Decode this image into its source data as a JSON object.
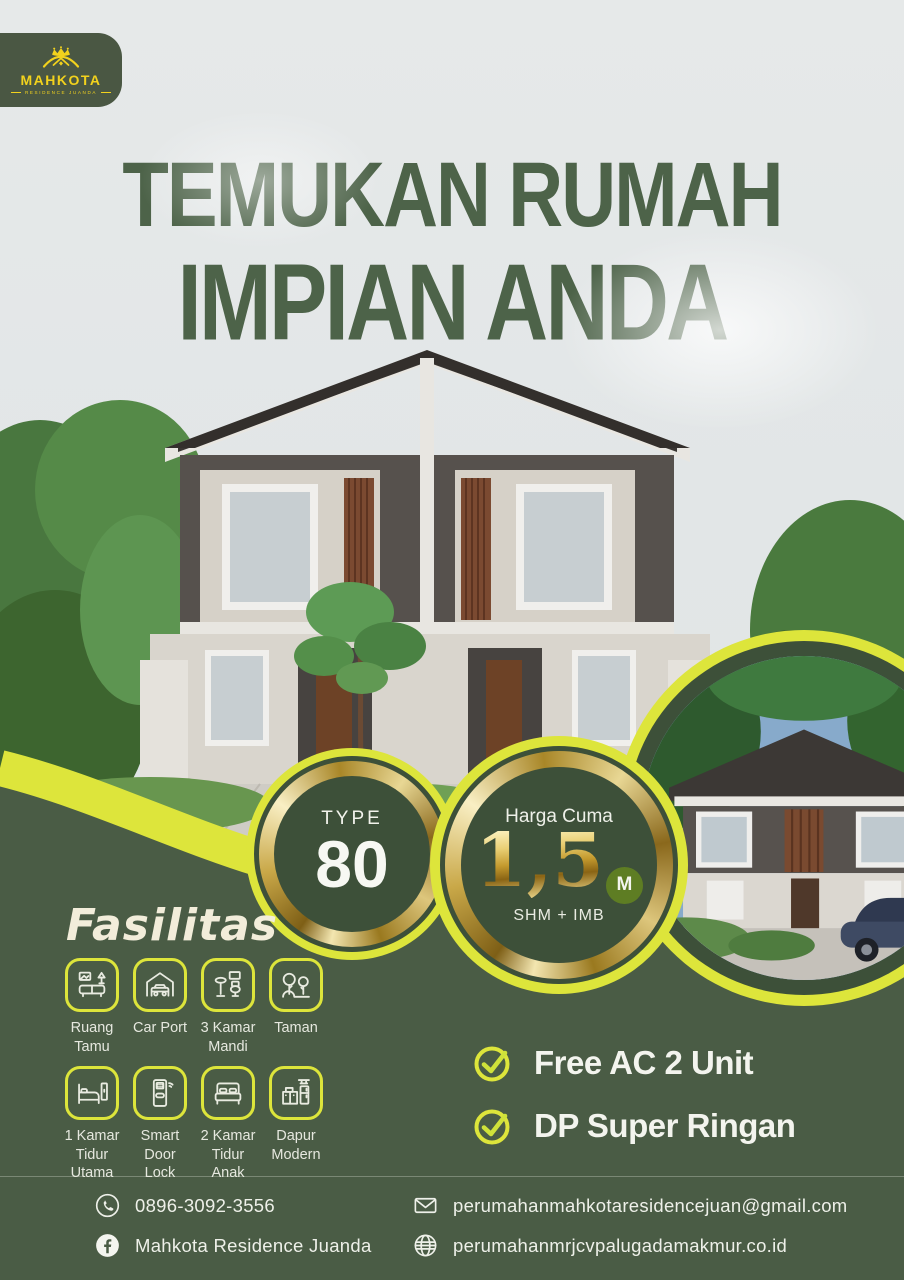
{
  "brand": {
    "name": "MAHKOTA",
    "tagline": "RESIDENCE JUANDA"
  },
  "hero": {
    "title_line1": "TEMUKAN RUMAH",
    "title_line2": "IMPIAN ANDA"
  },
  "type_badge": {
    "label": "TYPE",
    "value": "80"
  },
  "price_badge": {
    "label": "Harga Cuma",
    "value": "1,5",
    "unit": "M",
    "note": "SHM + IMB"
  },
  "facilities": {
    "heading": "Fasilitas",
    "items": [
      {
        "icon": "sofa-icon",
        "label": "Ruang Tamu"
      },
      {
        "icon": "carport-icon",
        "label": "Car Port"
      },
      {
        "icon": "bathroom-icon",
        "label": "3 Kamar Mandi"
      },
      {
        "icon": "garden-icon",
        "label": "Taman"
      },
      {
        "icon": "master-bedroom-icon",
        "label": "1 Kamar Tidur Utama"
      },
      {
        "icon": "smart-door-lock-icon",
        "label": "Smart Door Lock"
      },
      {
        "icon": "kids-bedroom-icon",
        "label": "2 Kamar Tidur Anak"
      },
      {
        "icon": "kitchen-icon",
        "label": "Dapur Modern"
      }
    ]
  },
  "benefits": [
    {
      "icon": "check-icon",
      "label": "Free AC 2 Unit"
    },
    {
      "icon": "check-icon",
      "label": "DP Super Ringan"
    }
  ],
  "contact": {
    "phone": "0896-3092-3556",
    "facebook": "Mahkota Residence Juanda",
    "email": "perumahanmahkotaresidencejuan@gmail.com",
    "website": "perumahanmrjcvpalugadamakmur.co.id"
  },
  "colors": {
    "lime": "#dde53b",
    "dark_green": "#4a5c45",
    "badge_green": "#3d5039",
    "title_green": "#4d6349",
    "gold": "#d0ac46",
    "logo_yellow": "#f2d21d",
    "background": "#e3e7e7",
    "text_light": "#eef0e9"
  }
}
